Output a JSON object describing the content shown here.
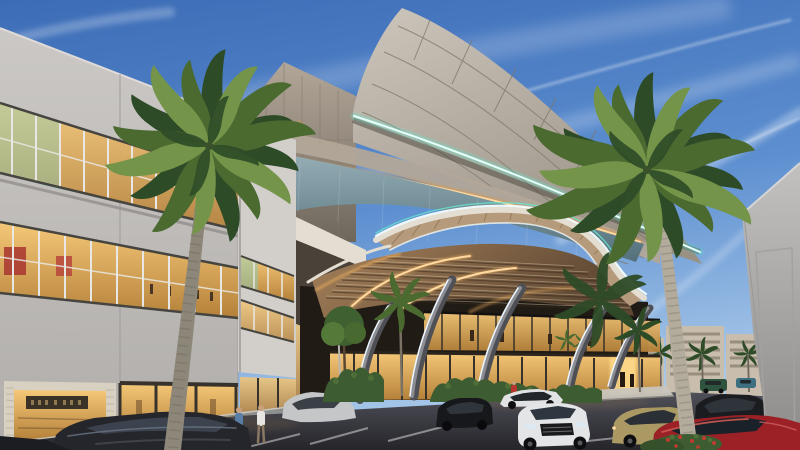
{
  "meta": {
    "title": "Shopping mall exterior — dusk architectural rendering",
    "type": "3d-architectural-render",
    "scene": "Curved-panel mall facade with LED accent strips, grand entrance canopy on angled sculptural pillars, retail strip building, royal palms, parking lot with cars and pedestrians",
    "time_of_day": "dusk",
    "canvas": {
      "width": 800,
      "height": 450
    }
  },
  "palette": {
    "sky_top": "#3c6cb6",
    "sky_mid": "#5d8fd0",
    "sky_horizon": "#a9c9e9",
    "cloud": "#ffffff",
    "fin_light": "#cdc6bc",
    "fin_dark": "#9a9185",
    "panel_seam": "#7e766a",
    "wing_light": "#b2a698",
    "wing_dark": "#6f675c",
    "led_teal": "#66e6cd",
    "led_teal_core": "#e8fffa",
    "led_amber": "#e59433",
    "led_amber_core": "#ffd9a0",
    "glass_top": "#96aeb6",
    "glass_bottom": "#53707b",
    "fascia_white": "#e3ddd2",
    "canopy_led": "#f2fdff",
    "arch_wood": "#b59a7b",
    "soffit_light": "#a5815a",
    "soffit_dark": "#5e4733",
    "soffit_glow": "#f7b45f",
    "interior_warm": "#f5c878",
    "interior_deep": "#b5813a",
    "interior_frame": "#37322b",
    "pillar_light": "#93959b",
    "pillar_dark": "#4e5056",
    "pillar_led": "#edf6ff",
    "bld_band": "#cbc8c5",
    "bld_band_dark": "#b0adaa",
    "bld_shadow": "#8b8885",
    "window_frame": "#45443f",
    "mullion": "#e9e7e3",
    "window_teal": "#7fd0c0",
    "storefront_glass": "#eec97f",
    "storefront_dark": "#2e2b25",
    "brick": "#d8d0c0",
    "sign_plate": "#3a3226",
    "pavement_top": "#50505a",
    "pavement_bottom": "#25252a",
    "parking_line": "#d6d6d8",
    "sidewalk": "#8b8984",
    "curb": "#c9c5bd",
    "hedge": "#3e5c31",
    "hedge_light": "#5d7f3f",
    "flower_red": "#c23b30",
    "frond_dark": "#2e4b27",
    "frond_mid": "#4a6a30",
    "frond_light": "#74944a",
    "trunk_left": "#8d8779",
    "trunk_right": "#b3ab9c",
    "trunk_ring": "#6b665c",
    "bg_building": "#c9bead",
    "bg_window": "#93897a",
    "wall_light": "#c3c1c0",
    "wall_dark": "#8d8b89",
    "skin": "#c9a17d",
    "shirt_blue": "#5b7ea6",
    "shirt_white": "#e8e6e0",
    "shirt_red": "#b5362c",
    "glass_dark": "#2f343c"
  },
  "vehicles": [
    {
      "name": "dark-sedan-foreground",
      "color": "#25262c"
    },
    {
      "name": "white-sedan",
      "color": "#e3e5e7"
    },
    {
      "name": "black-hatchback",
      "color": "#17181b"
    },
    {
      "name": "white-coupe",
      "color": "#e0e2e4"
    },
    {
      "name": "tan-sedan",
      "color": "#ab9964"
    },
    {
      "name": "black-suv",
      "color": "#1b1c20"
    },
    {
      "name": "red-car",
      "color": "#9c2126"
    },
    {
      "name": "green-suv",
      "color": "#2e5440"
    },
    {
      "name": "teal-hatchback",
      "color": "#3d6f81"
    },
    {
      "name": "silver-car",
      "color": "#c4c6c8"
    }
  ],
  "scene": {
    "landmarks": [
      "curved-panel facade fin",
      "teal LED edge strips",
      "amber LED strip",
      "clerestory glass band",
      "arched entrance canopy with wood soffit",
      "angled LED-edged pillars",
      "two-level lit interior",
      "retail strip building with lit shopfronts",
      "two large royal palms",
      "parking lot with nine cars",
      "background condo buildings",
      "pedestrians on walkway"
    ],
    "people_count_foreground": 3,
    "large_palm_count": 2
  }
}
